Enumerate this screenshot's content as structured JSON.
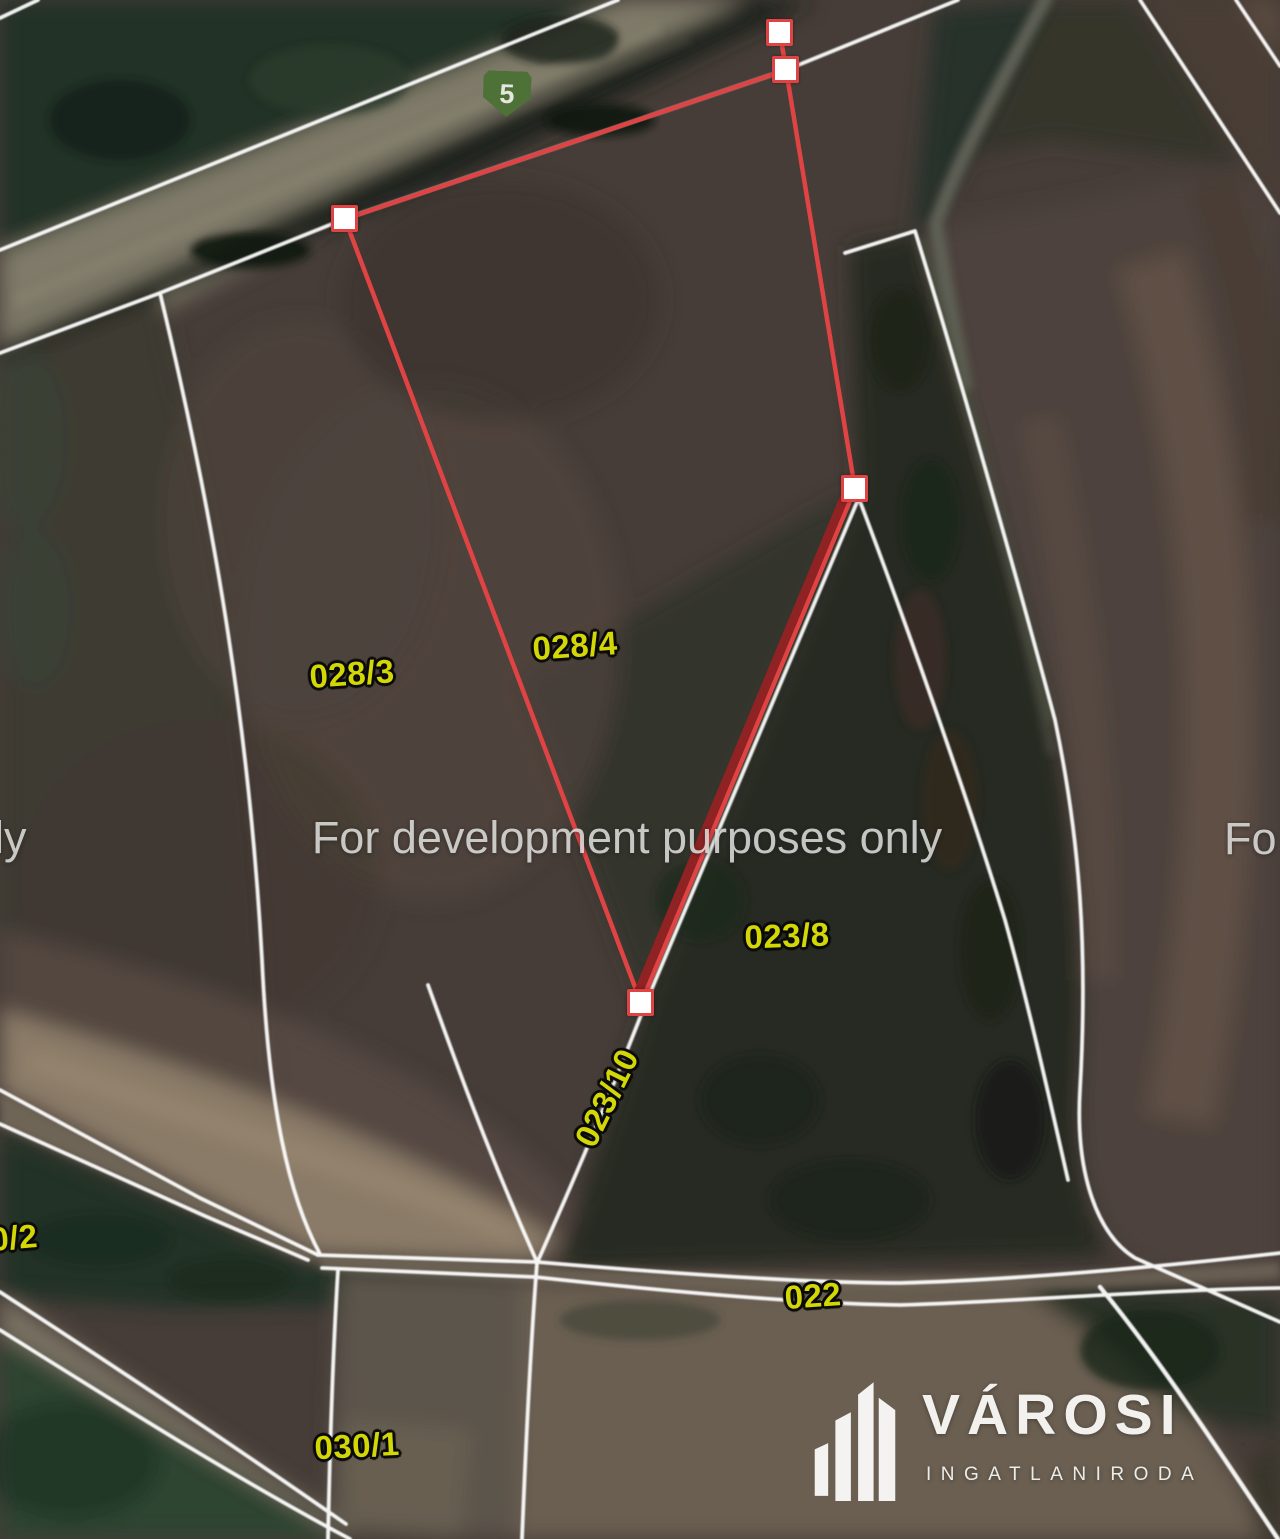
{
  "map": {
    "watermark": {
      "center": "For development purposes only",
      "partial_left": "ly",
      "partial_right": "Fo"
    },
    "road_shield": {
      "number": "5"
    },
    "parcels": [
      {
        "label": "028/3"
      },
      {
        "label": "028/4"
      },
      {
        "label": "023/8"
      },
      {
        "label": "023/10"
      },
      {
        "label": "022"
      },
      {
        "label": "030/1"
      },
      {
        "label": "0/2"
      }
    ]
  },
  "selection": {
    "vertex_count": 5,
    "vertices": [
      {
        "x": 780,
        "y": 33
      },
      {
        "x": 786,
        "y": 70
      },
      {
        "x": 345,
        "y": 219
      },
      {
        "x": 641,
        "y": 1003
      },
      {
        "x": 855,
        "y": 489
      }
    ],
    "stroke_color": "#e04343"
  },
  "logo": {
    "name": "VÁROSI",
    "subtitle": "INGATLANIRODA"
  },
  "colors": {
    "boundary_white": "#ffffff",
    "parcel_label_yellow": "#d3d705",
    "selection_red": "#e04343",
    "selected_boundary_dark_red": "#8f2222",
    "shield_green": "#4e7137",
    "watermark_gray": "#dcdcda"
  }
}
